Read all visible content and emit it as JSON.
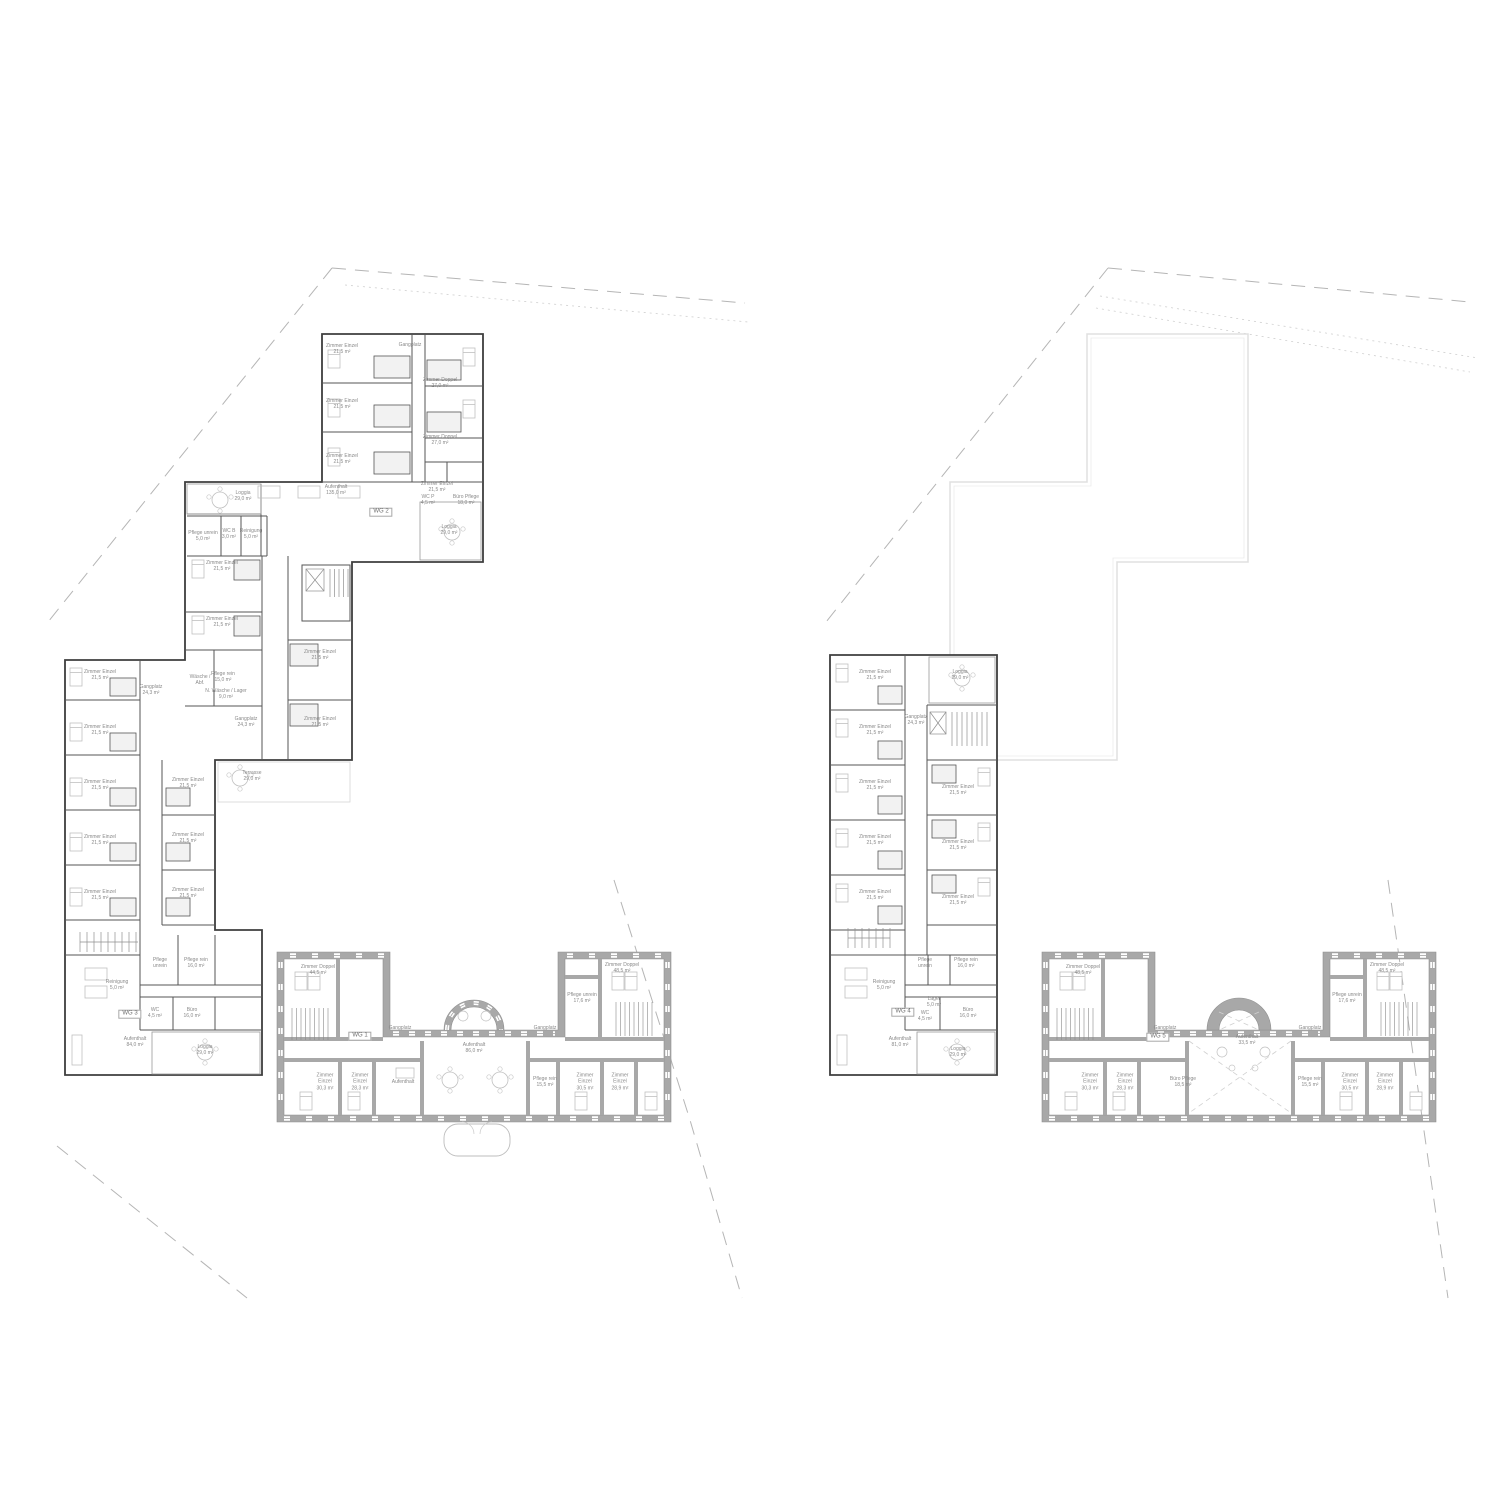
{
  "colors": {
    "wall_dark": "#3e3e3e",
    "wall_interior": "#555555",
    "poche_fill": "#a8a8a8",
    "poche_edge": "#8f8f8f",
    "furniture": "#c0c0c0",
    "site_line": "#b5b5b5",
    "roof_outline": "#e3e3e3",
    "label_text": "#8a8a8a"
  },
  "plans": [
    {
      "name": "plan-left",
      "labels": [
        {
          "t": "Zimmer Einzel\n21,5 m²",
          "x": 342,
          "y": 349
        },
        {
          "t": "Gangplatz",
          "x": 410,
          "y": 345
        },
        {
          "t": "Zimmer Doppel\n27,0 m²",
          "x": 440,
          "y": 383
        },
        {
          "t": "Zimmer Einzel\n21,5 m²",
          "x": 342,
          "y": 404
        },
        {
          "t": "Zimmer Doppel\n27,0 m²",
          "x": 440,
          "y": 440
        },
        {
          "t": "Zimmer Einzel\n21,5 m²",
          "x": 342,
          "y": 459
        },
        {
          "t": "Zimmer Einzel\n21,5 m²",
          "x": 437,
          "y": 487
        },
        {
          "t": "WC P\n4,5 m²",
          "x": 428,
          "y": 500
        },
        {
          "t": "Büro Pflege\n18,0 m²",
          "x": 466,
          "y": 500
        },
        {
          "t": "Loggia\n29,0 m²",
          "x": 243,
          "y": 496
        },
        {
          "t": "Aufenthalt\n135,0 m²",
          "x": 336,
          "y": 490
        },
        {
          "t": "Loggia\n29,0 m²",
          "x": 449,
          "y": 530
        },
        {
          "t": "Pflege unrein\n5,0 m²",
          "x": 203,
          "y": 536
        },
        {
          "t": "WC B\n3,0 m²",
          "x": 229,
          "y": 534
        },
        {
          "t": "Reinigung\n5,0 m²",
          "x": 251,
          "y": 534
        },
        {
          "t": "Zimmer Einzel\n21,5 m²",
          "x": 222,
          "y": 566
        },
        {
          "t": "Zimmer Einzel\n21,5 m²",
          "x": 222,
          "y": 622
        },
        {
          "t": "Zimmer Einzel\n21,5 m²",
          "x": 320,
          "y": 655
        },
        {
          "t": "Zimmer Einzel\n21,5 m²",
          "x": 320,
          "y": 722
        },
        {
          "t": "Wäsche /\nAbf.",
          "x": 200,
          "y": 680
        },
        {
          "t": "Pflege rein\n15,0 m²",
          "x": 223,
          "y": 677
        },
        {
          "t": "N. Wäsche / Lager\n9,0 m²",
          "x": 226,
          "y": 694
        },
        {
          "t": "Gangplatz\n24,3 m²",
          "x": 246,
          "y": 722
        },
        {
          "t": "Terrasse\n29,0 m²",
          "x": 252,
          "y": 776
        },
        {
          "t": "Zimmer Einzel\n21,5 m²",
          "x": 100,
          "y": 675
        },
        {
          "t": "Zimmer Einzel\n21,5 m²",
          "x": 100,
          "y": 730
        },
        {
          "t": "Zimmer Einzel\n21,5 m²",
          "x": 100,
          "y": 785
        },
        {
          "t": "Zimmer Einzel\n21,5 m²",
          "x": 100,
          "y": 840
        },
        {
          "t": "Zimmer Einzel\n21,5 m²",
          "x": 100,
          "y": 895
        },
        {
          "t": "Gangplatz\n24,3 m²",
          "x": 151,
          "y": 690
        },
        {
          "t": "Zimmer Einzel\n21,5 m²",
          "x": 188,
          "y": 783
        },
        {
          "t": "Zimmer Einzel\n21,5 m²",
          "x": 188,
          "y": 838
        },
        {
          "t": "Zimmer Einzel\n21,5 m²",
          "x": 188,
          "y": 893
        },
        {
          "t": "Pflege\nunrein",
          "x": 160,
          "y": 963
        },
        {
          "t": "Pflege rein\n16,0 m²",
          "x": 196,
          "y": 963
        },
        {
          "t": "Reinigung\n5,0 m²",
          "x": 117,
          "y": 985
        },
        {
          "t": "WC\n4,5 m²",
          "x": 155,
          "y": 1013
        },
        {
          "t": "Büro\n16,0 m²",
          "x": 192,
          "y": 1013
        },
        {
          "t": "Aufenthalt\n84,0 m²",
          "x": 135,
          "y": 1042
        },
        {
          "t": "Loggia\n29,0 m²",
          "x": 205,
          "y": 1050
        },
        {
          "t": "Zimmer Doppel\n44,5 m²",
          "x": 318,
          "y": 970
        },
        {
          "t": "Gangplatz",
          "x": 400,
          "y": 1028
        },
        {
          "t": "Zimmer\nEinzel\n30,3 m²",
          "x": 325,
          "y": 1082
        },
        {
          "t": "Zimmer\nEinzel\n28,3 m²",
          "x": 360,
          "y": 1082
        },
        {
          "t": "Aufenthalt",
          "x": 403,
          "y": 1082
        },
        {
          "t": "Aufenthalt\n86,0 m²",
          "x": 474,
          "y": 1048
        },
        {
          "t": "Gangplatz",
          "x": 545,
          "y": 1028
        },
        {
          "t": "Pflege rein\n15,5 m²",
          "x": 545,
          "y": 1082
        },
        {
          "t": "Zimmer\nEinzel\n30,5 m²",
          "x": 585,
          "y": 1082
        },
        {
          "t": "Zimmer\nEinzel\n28,9 m²",
          "x": 620,
          "y": 1082
        },
        {
          "t": "Pflege unrein\n17,6 m²",
          "x": 582,
          "y": 998
        },
        {
          "t": "Zimmer Doppel\n48,5 m²",
          "x": 622,
          "y": 968
        }
      ],
      "tags": [
        {
          "t": "WG 1",
          "x": 360,
          "y": 1036
        },
        {
          "t": "WG 2",
          "x": 381,
          "y": 512
        },
        {
          "t": "WG 3",
          "x": 130,
          "y": 1014
        }
      ]
    },
    {
      "name": "plan-right",
      "labels": [
        {
          "t": "Zimmer Einzel\n21,5 m²",
          "x": 875,
          "y": 675
        },
        {
          "t": "Zimmer Einzel\n21,5 m²",
          "x": 875,
          "y": 730
        },
        {
          "t": "Zimmer Einzel\n21,5 m²",
          "x": 875,
          "y": 785
        },
        {
          "t": "Zimmer Einzel\n21,5 m²",
          "x": 875,
          "y": 840
        },
        {
          "t": "Zimmer Einzel\n21,5 m²",
          "x": 875,
          "y": 895
        },
        {
          "t": "Loggia\n29,0 m²",
          "x": 960,
          "y": 675
        },
        {
          "t": "Gangplatz\n24,3 m²",
          "x": 916,
          "y": 720
        },
        {
          "t": "Zimmer Einzel\n21,5 m²",
          "x": 958,
          "y": 790
        },
        {
          "t": "Zimmer Einzel\n21,5 m²",
          "x": 958,
          "y": 845
        },
        {
          "t": "Zimmer Einzel\n21,5 m²",
          "x": 958,
          "y": 900
        },
        {
          "t": "Pflege\nunrein",
          "x": 925,
          "y": 963
        },
        {
          "t": "Pflege rein\n16,0 m²",
          "x": 966,
          "y": 963
        },
        {
          "t": "Reinigung\n5,0 m²",
          "x": 884,
          "y": 985
        },
        {
          "t": "Lager\n5,0 m²",
          "x": 934,
          "y": 1002
        },
        {
          "t": "WC\n4,5 m²",
          "x": 925,
          "y": 1016
        },
        {
          "t": "Büro\n16,0 m²",
          "x": 968,
          "y": 1013
        },
        {
          "t": "Aufenthalt\n81,0 m²",
          "x": 900,
          "y": 1042
        },
        {
          "t": "Loggia\n29,0 m²",
          "x": 958,
          "y": 1052
        },
        {
          "t": "Zimmer Doppel\n48,5 m²",
          "x": 1083,
          "y": 970
        },
        {
          "t": "Gangplatz",
          "x": 1165,
          "y": 1028
        },
        {
          "t": "Zimmer\nEinzel\n30,3 m²",
          "x": 1090,
          "y": 1082
        },
        {
          "t": "Zimmer\nEinzel\n28,3 m²",
          "x": 1125,
          "y": 1082
        },
        {
          "t": "Büro Pflege\n18,5 m²",
          "x": 1183,
          "y": 1082
        },
        {
          "t": "Aufenthalt\n33,5 m²",
          "x": 1247,
          "y": 1040
        },
        {
          "t": "Gangplatz",
          "x": 1310,
          "y": 1028
        },
        {
          "t": "Pflege rein\n15,5 m²",
          "x": 1310,
          "y": 1082
        },
        {
          "t": "Zimmer\nEinzel\n30,5 m²",
          "x": 1350,
          "y": 1082
        },
        {
          "t": "Zimmer\nEinzel\n28,9 m²",
          "x": 1385,
          "y": 1082
        },
        {
          "t": "Pflege unrein\n17,6 m²",
          "x": 1347,
          "y": 998
        },
        {
          "t": "Zimmer Doppel\n48,5 m²",
          "x": 1387,
          "y": 968
        }
      ],
      "tags": [
        {
          "t": "WG 4",
          "x": 903,
          "y": 1012
        },
        {
          "t": "WG 5",
          "x": 1158,
          "y": 1037
        }
      ]
    }
  ]
}
